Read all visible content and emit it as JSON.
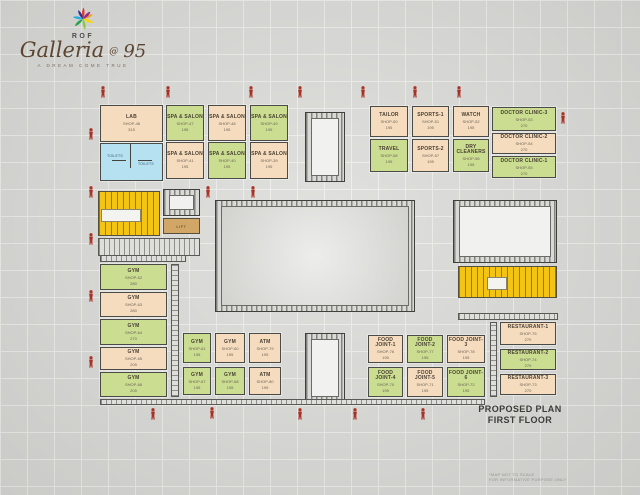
{
  "logo": {
    "brand": "ROF",
    "title": "Galleria",
    "at": "@",
    "number": "95",
    "tagline": "A DREAM COME TRUE"
  },
  "plan_title": {
    "line1": "PROPOSED PLAN",
    "line2": "FIRST FLOOR"
  },
  "footnote": {
    "line1": "*MAP NOT TO SCALE",
    "line2": "FOR INFORMATIVE PURPOSE ONLY"
  },
  "labels": {
    "lift": "LIFT",
    "toilets_left": "TOILETS",
    "toilets_right": "TOILETS"
  },
  "colors": {
    "room_peach": "#f6dcbe",
    "room_green": "#cadd90",
    "toilet_blue": "#b5e1f1",
    "stair_yellow": "#f4c414",
    "lift_tan": "#d2a667",
    "figure_red": "#a93226",
    "background": "#d8d8d5"
  },
  "u": {
    "lab": {
      "name": "LAB",
      "shop": "SHOP-46",
      "area": "315"
    },
    "spa_top": [
      {
        "name": "SPA & SALON",
        "shop": "SHOP-47",
        "area": "195"
      },
      {
        "name": "SPA & SALON",
        "shop": "SHOP-48",
        "area": "195"
      },
      {
        "name": "SPA & SALON",
        "shop": "SHOP-49",
        "area": "195"
      }
    ],
    "spa_bot": [
      {
        "name": "SPA & SALON",
        "shop": "SHOP-41",
        "area": "195"
      },
      {
        "name": "SPA & SALON",
        "shop": "SHOP-40",
        "area": "195"
      },
      {
        "name": "SPA & SALON",
        "shop": "SHOP-39",
        "area": "195"
      }
    ],
    "right_top": [
      {
        "name": "TAILOR",
        "shop": "SHOP-50",
        "area": "195"
      },
      {
        "name": "SPORTS-1",
        "shop": "SHOP-51",
        "area": "195"
      },
      {
        "name": "WATCH",
        "shop": "SHOP-52",
        "area": "195"
      }
    ],
    "right_bot": [
      {
        "name": "TRAVEL",
        "shop": "SHOP-58",
        "area": "195"
      },
      {
        "name": "SPORTS-2",
        "shop": "SHOP-57",
        "area": "195"
      },
      {
        "name": "DRY CLEANERS",
        "shop": "SHOP-56",
        "area": "195"
      }
    ],
    "clinics": [
      {
        "name": "DOCTOR CLINIC-3",
        "shop": "SHOP-53",
        "area": "270"
      },
      {
        "name": "DOCTOR CLINIC-2",
        "shop": "SHOP-54",
        "area": "270"
      },
      {
        "name": "DOCTOR CLINIC-1",
        "shop": "SHOP-55",
        "area": "270"
      }
    ],
    "gym_col": [
      {
        "name": "GYM",
        "shop": "SHOP-62",
        "area": "280"
      },
      {
        "name": "GYM",
        "shop": "SHOP-63",
        "area": "280"
      },
      {
        "name": "GYM",
        "shop": "SHOP-64",
        "area": "270"
      },
      {
        "name": "GYM",
        "shop": "SHOP-65",
        "area": "205"
      },
      {
        "name": "GYM",
        "shop": "SHOP-66",
        "area": "205"
      }
    ],
    "mid_top": [
      {
        "name": "GYM",
        "shop": "SHOP-61",
        "area": "195"
      },
      {
        "name": "GYM",
        "shop": "SHOP-60",
        "area": "195"
      },
      {
        "name": "ATM",
        "shop": "SHOP-79",
        "area": "195"
      }
    ],
    "mid_bot": [
      {
        "name": "GYM",
        "shop": "SHOP-67",
        "area": "195"
      },
      {
        "name": "GYM",
        "shop": "SHOP-68",
        "area": "195"
      },
      {
        "name": "ATM",
        "shop": "SHOP-80",
        "area": "195"
      }
    ],
    "food_top": [
      {
        "name": "FOOD JOINT-1",
        "shop": "SHOP-76",
        "area": "195"
      },
      {
        "name": "FOOD JOINT-2",
        "shop": "SHOP-77",
        "area": "195"
      },
      {
        "name": "FOOD JOINT-3",
        "shop": "SHOP-78",
        "area": "195"
      }
    ],
    "food_bot": [
      {
        "name": "FOOD JOINT-4",
        "shop": "SHOP-70",
        "area": "195"
      },
      {
        "name": "FOOD JOINT-5",
        "shop": "SHOP-71",
        "area": "195"
      },
      {
        "name": "FOOD JOINT-6",
        "shop": "SHOP-72",
        "area": "195"
      }
    ],
    "restaurants": [
      {
        "name": "RESTAURANT-1",
        "shop": "SHOP-75",
        "area": "270"
      },
      {
        "name": "RESTAURANT-2",
        "shop": "SHOP-74",
        "area": "270"
      },
      {
        "name": "RESTAURANT-3",
        "shop": "SHOP-73",
        "area": "270"
      }
    ]
  }
}
